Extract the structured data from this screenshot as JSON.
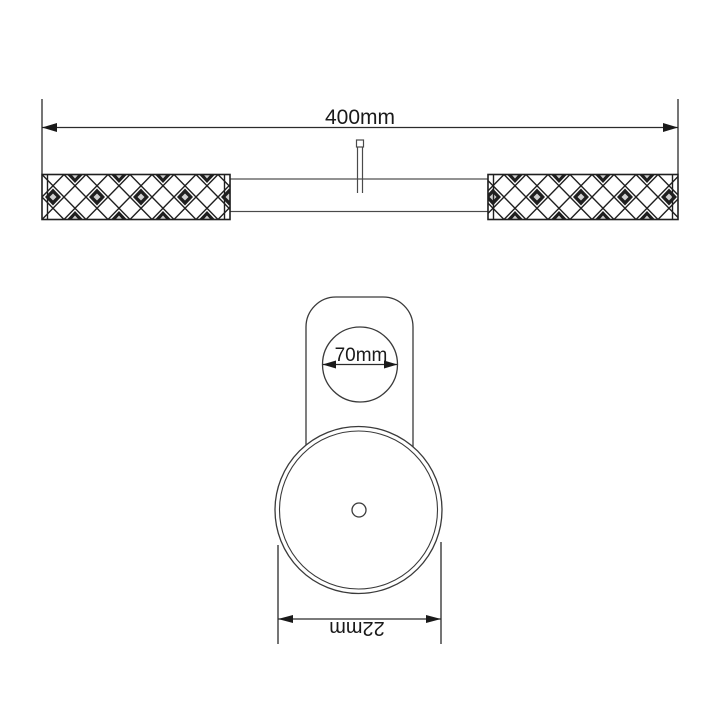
{
  "diagram": {
    "type": "technical-drawing",
    "background_color": "#ffffff",
    "line_color": "#2b2b2b",
    "knurl_color": "#1f1f1f",
    "views": {
      "top": {
        "name": "rod-with-knurled-grips",
        "width_dimension_label": "400mm"
      },
      "front": {
        "name": "wall-bracket",
        "hole_dimension_label": "70mm",
        "base_dimension_label": "22mm",
        "base_label_rotation_deg": 180
      }
    }
  }
}
